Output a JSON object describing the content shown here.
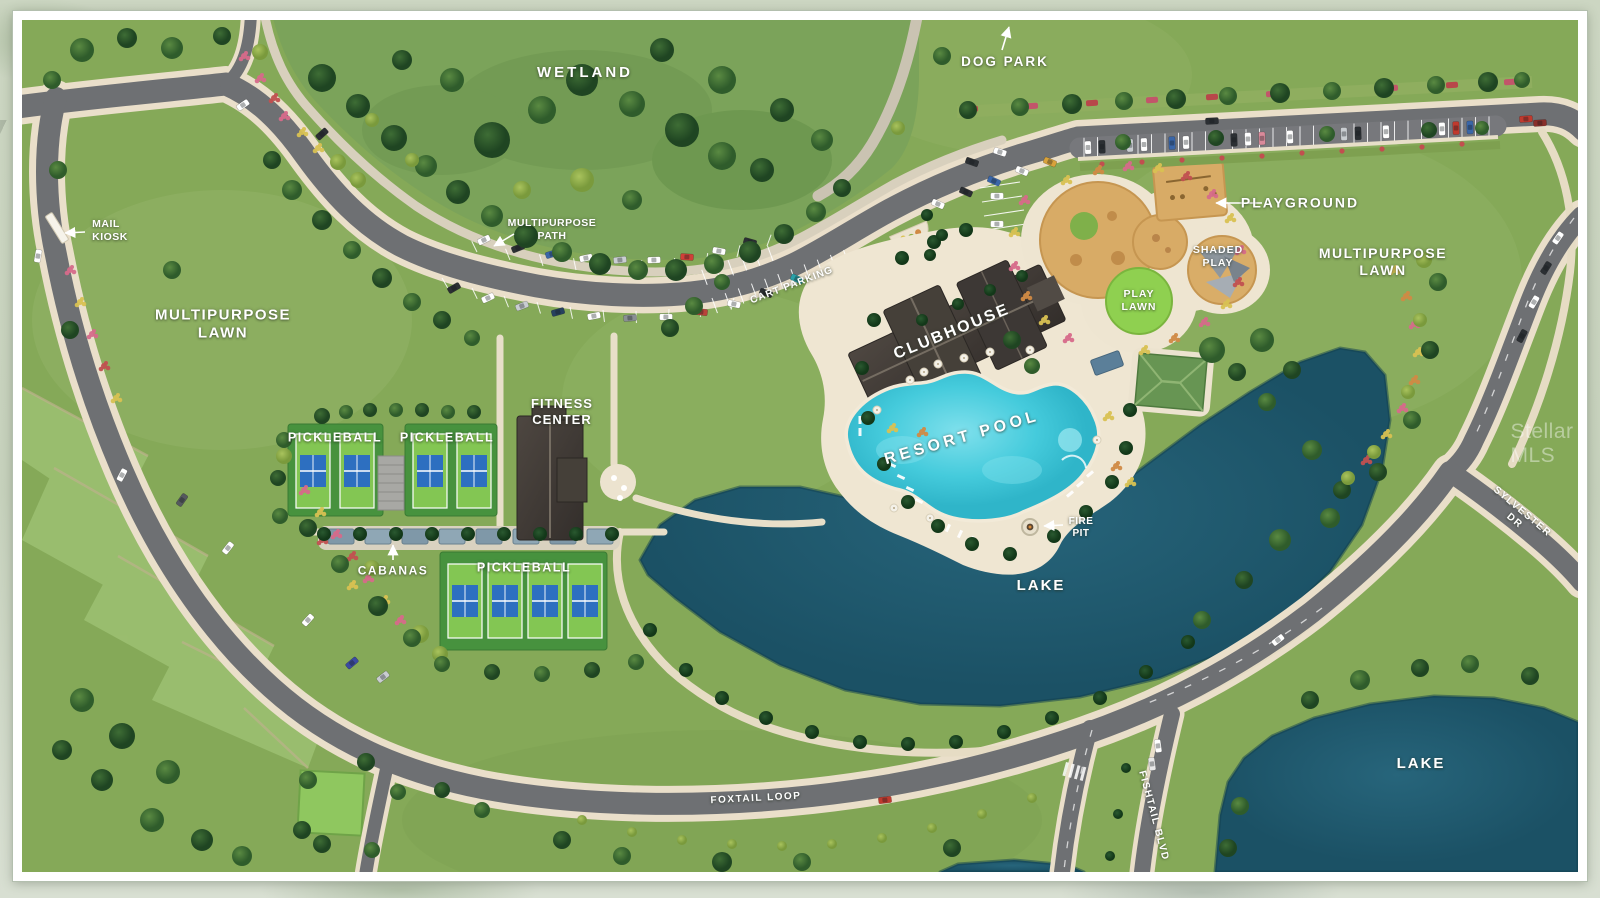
{
  "type": "community-site-plan",
  "labels": {
    "wetland": "WETLAND",
    "dog_park": "DOG PARK",
    "playground": "PLAYGROUND",
    "shaded_play": "SHADED\nPLAY",
    "play_lawn": "PLAY\nLAWN",
    "multipurpose_lawn_right": "MULTIPURPOSE\nLAWN",
    "multipurpose_lawn_left": "MULTIPURPOSE\nLAWN",
    "multipurpose_path": "MULTIPURPOSE\nPATH",
    "cart_parking": "CART PARKING",
    "mail_kiosk": "MAIL\nKIOSK",
    "clubhouse": "CLUBHOUSE",
    "resort_pool": "RESORT POOL",
    "fitness_center": "FITNESS\nCENTER",
    "pickleball_left": "PICKLEBALL",
    "pickleball_mid": "PICKLEBALL",
    "pickleball_bottom": "PICKLEBALL",
    "cabanas": "CABANAS",
    "fire_pit": "FIRE\nPIT",
    "lake_main": "LAKE",
    "lake_right": "LAKE",
    "foxtail_loop": "FOXTAIL LOOP",
    "fishtail_blvd": "FISHTAIL BLVD",
    "sylvester_dr": "SYLVESTER DR"
  },
  "watermark": "Stellar MLS",
  "colors": {
    "grass": "#85a958",
    "grass_light": "#9dc173",
    "wetland": "#7ba35a",
    "road": "#6e7073",
    "sidewalk": "#eadfca",
    "path": "#d8d0bd",
    "lake": "#1f5c70",
    "pool": "#3fc8da",
    "deck": "#efe6d2",
    "roof": "#413c38",
    "court_green": "#83c653",
    "court_blue": "#2d6fc0",
    "court_surround": "#47923e",
    "playground_sand": "#d8ab66",
    "play_lawn": "#8fd050",
    "pavilion_roof": "#679553",
    "cabana_blue": "#7f98a8",
    "label_text": "#ffffff"
  }
}
